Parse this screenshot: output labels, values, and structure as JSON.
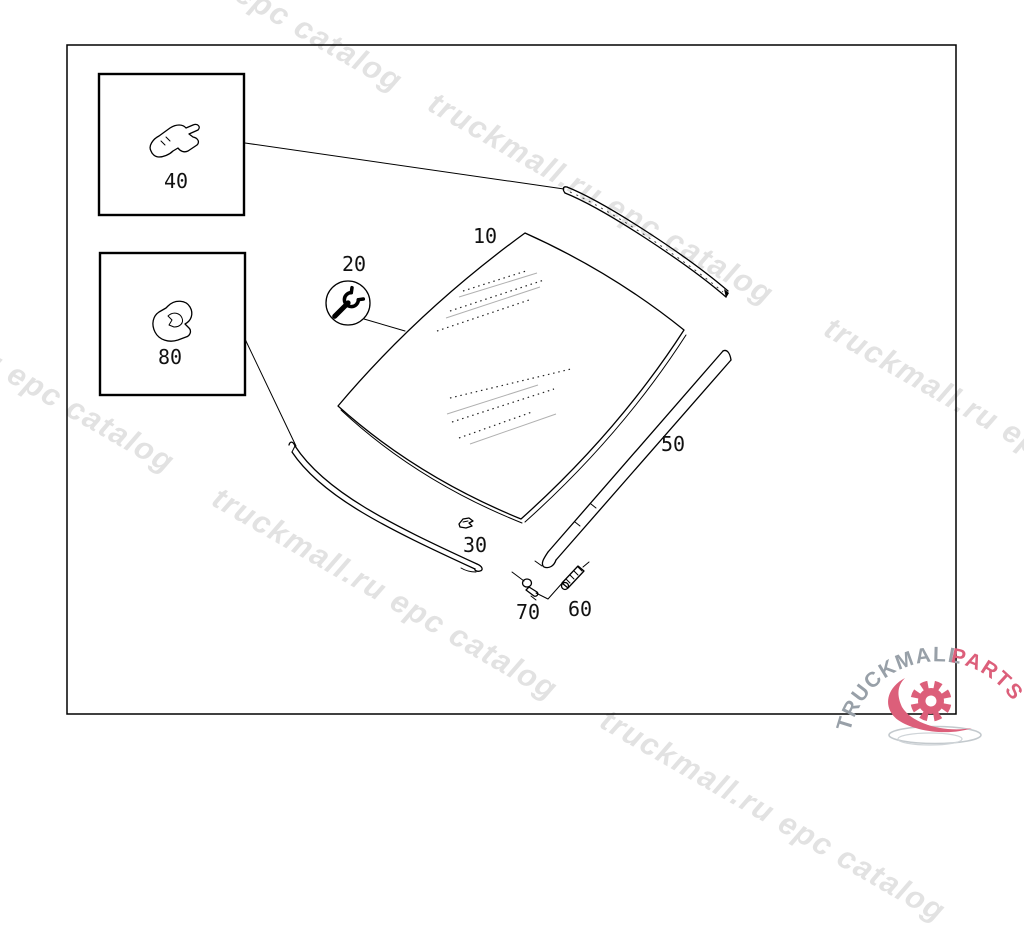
{
  "watermark": {
    "text": "truckmall.ru epc catalog"
  },
  "logo": {
    "brand_primary": "TRUCKMALL",
    "brand_secondary": "PARTS",
    "primary_color": "#98a0a8",
    "secondary_color": "#dc5f7a"
  },
  "diagram": {
    "type": "exploded-parts-diagram",
    "parts": [
      {
        "label": "10"
      },
      {
        "label": "20"
      },
      {
        "label": "30"
      },
      {
        "label": "40"
      },
      {
        "label": "50"
      },
      {
        "label": "60"
      },
      {
        "label": "70"
      },
      {
        "label": "80"
      }
    ]
  }
}
